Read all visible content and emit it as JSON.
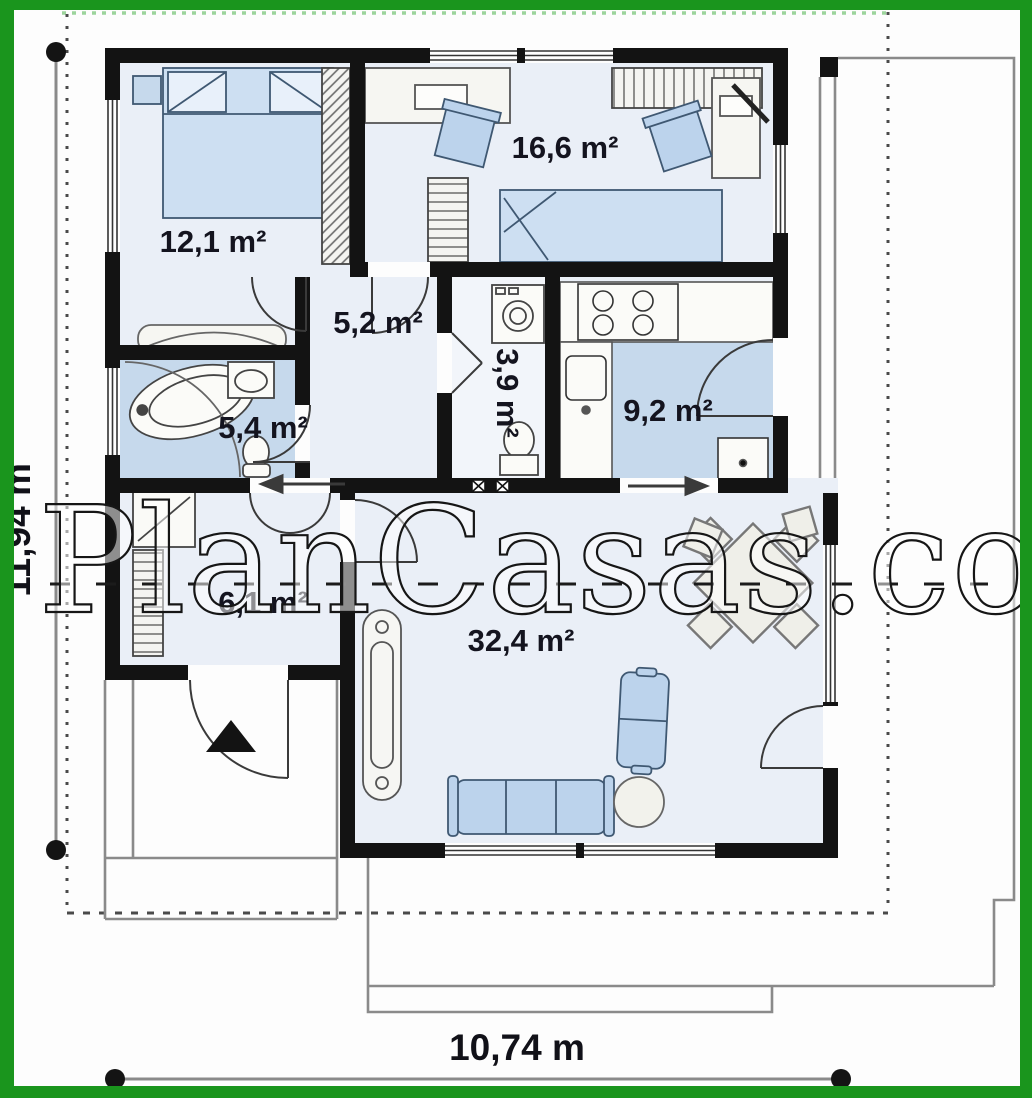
{
  "plan": {
    "watermark": "PlanCasas.com",
    "dimensions": {
      "height_label": "11,94 m",
      "width_label": "10,74 m"
    },
    "rooms": [
      {
        "name": "bedroom-main",
        "area_label": "12,1 m²"
      },
      {
        "name": "bedroom-second",
        "area_label": "16,6 m²"
      },
      {
        "name": "hall",
        "area_label": "5,2 m²"
      },
      {
        "name": "wc-utility",
        "area_label": "3,9 m²"
      },
      {
        "name": "bathroom",
        "area_label": "5,4 m²"
      },
      {
        "name": "kitchen",
        "area_label": "9,2 m²"
      },
      {
        "name": "entry-vestibule",
        "area_label": "6,1 m²"
      },
      {
        "name": "living-room",
        "area_label": "32,4 m²"
      }
    ],
    "colors": {
      "border_green": "#1a951d",
      "wall_black": "#131313",
      "floor_light": "#eaeff7",
      "floor_blue": "#c6d9ec",
      "furniture_blue": "#bcd3ec",
      "outline_gray": "#888888"
    }
  }
}
